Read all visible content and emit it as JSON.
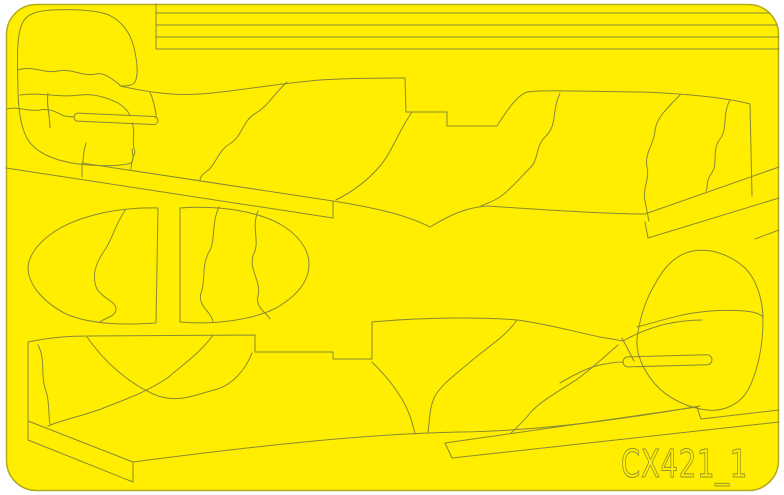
{
  "product": {
    "code": "CX421_1"
  },
  "colors": {
    "page_background": "#ffffff",
    "sheet_fill": "#ffee00",
    "sheet_edge": "#b3aa1c",
    "cut_line": "#8a8a33",
    "engraving": "#94942e"
  }
}
